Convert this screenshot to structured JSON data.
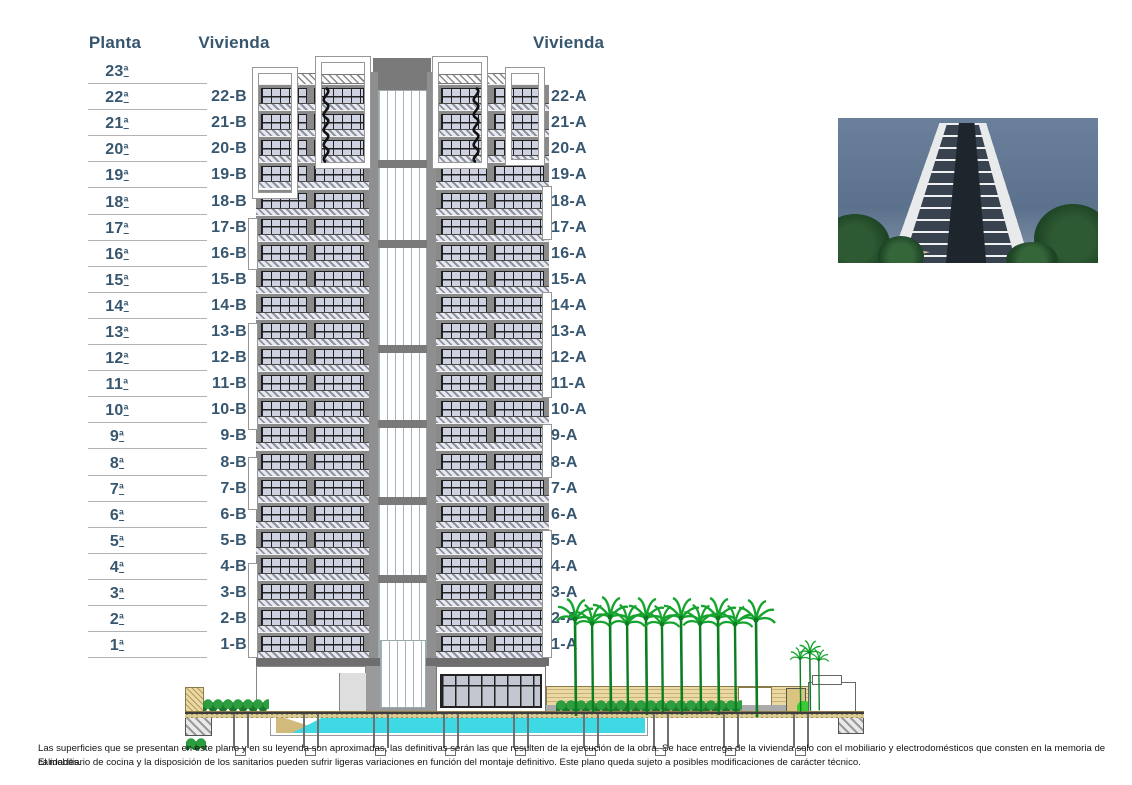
{
  "headers": {
    "planta": "Planta",
    "vivienda_b": "Vivienda",
    "vivienda_a": "Vivienda"
  },
  "plantas": [
    "23ª",
    "22ª",
    "21ª",
    "20ª",
    "19ª",
    "18ª",
    "17ª",
    "16ª",
    "15ª",
    "14ª",
    "13ª",
    "12ª",
    "11ª",
    "10ª",
    "9ª",
    "8ª",
    "7ª",
    "6ª",
    "5ª",
    "4ª",
    "3ª",
    "2ª",
    "1ª"
  ],
  "viviendas_b": [
    "22-B",
    "21-B",
    "20-B",
    "19-B",
    "18-B",
    "17-B",
    "16-B",
    "15-B",
    "14-B",
    "13-B",
    "12-B",
    "11-B",
    "10-B",
    "9-B",
    "8-B",
    "7-B",
    "6-B",
    "5-B",
    "4-B",
    "3-B",
    "2-B",
    "1-B"
  ],
  "viviendas_a": [
    "22-A",
    "21-A",
    "20-A",
    "19-A",
    "18-A",
    "17-A",
    "16-A",
    "15-A",
    "14-A",
    "13-A",
    "12-A",
    "11-A",
    "10-A",
    "9-A",
    "8-A",
    "7-A",
    "6-A",
    "5-A",
    "4-A",
    "3-A",
    "2-A",
    "1-A"
  ],
  "disclaimer": {
    "line1": "Las superficies que se presentan en este plano y en su leyenda son aproximadas, las definitivas serán las que resulten de la ejecución de la obra. Se hace entrega de la vivienda solo con el mobiliario y electrodomésticos que consten en la memoria de calidades.",
    "line2": "El mobiliario de cocina y la disposición de los sanitarios pueden sufrir ligeras variaciones en función del montaje definitivo. Este plano queda sujeto a posibles modificaciones de carácter técnico."
  },
  "palette": {
    "label_color": "#37566F",
    "divider_color": "#B3B3B3",
    "facade_gray": "#8A8A8A",
    "glass": "#CDD1E0",
    "pool": "#3ED9E4",
    "sand": "#EAD9A3",
    "palm_green": "#129E2F"
  }
}
